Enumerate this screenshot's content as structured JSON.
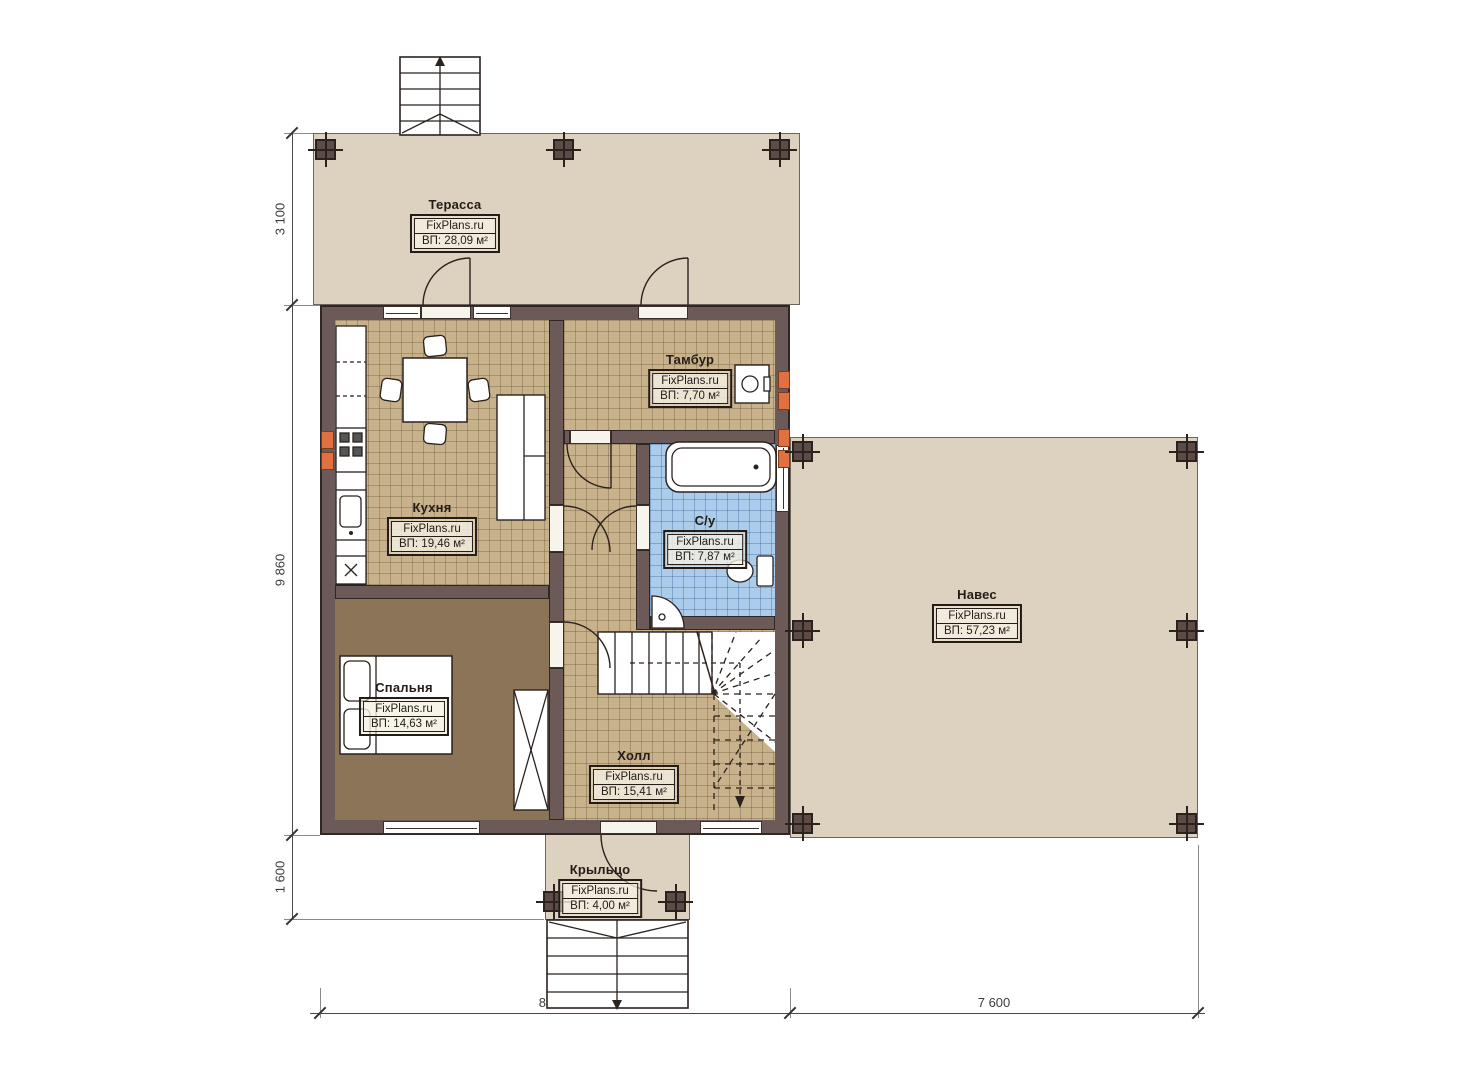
{
  "rooms": {
    "terrace": {
      "name": "Терасса",
      "brand": "FixPlans.ru",
      "area": "ВП: 28,09 м²"
    },
    "tambur": {
      "name": "Тамбур",
      "brand": "FixPlans.ru",
      "area": "ВП: 7,70 м²"
    },
    "kitchen": {
      "name": "Кухня",
      "brand": "FixPlans.ru",
      "area": "ВП: 19,46 м²"
    },
    "bathroom": {
      "name": "С/у",
      "brand": "FixPlans.ru",
      "area": "ВП: 7,87 м²"
    },
    "canopy": {
      "name": "Навес",
      "brand": "FixPlans.ru",
      "area": "ВП: 57,23 м²"
    },
    "bedroom": {
      "name": "Спальня",
      "brand": "FixPlans.ru",
      "area": "ВП: 14,63 м²"
    },
    "hall": {
      "name": "Холл",
      "brand": "FixPlans.ru",
      "area": "ВП: 15,41 м²"
    },
    "porch": {
      "name": "Крыльцо",
      "brand": "FixPlans.ru",
      "area": "ВП: 4,00 м²"
    }
  },
  "dimensions": {
    "left": [
      "3 100",
      "9 860",
      "1 600"
    ],
    "bottom": [
      "8 860",
      "7 600"
    ]
  },
  "colors": {
    "wall": "#6b5a58",
    "wall_outline": "#2f2724",
    "tile_floor": "#c7b28c",
    "bathroom_floor": "#abcdeb",
    "bedroom_floor": "#8b7457",
    "outdoor_floor": "#ddd2bf",
    "radiator": "#e0703f",
    "linework": "#2b221e"
  }
}
